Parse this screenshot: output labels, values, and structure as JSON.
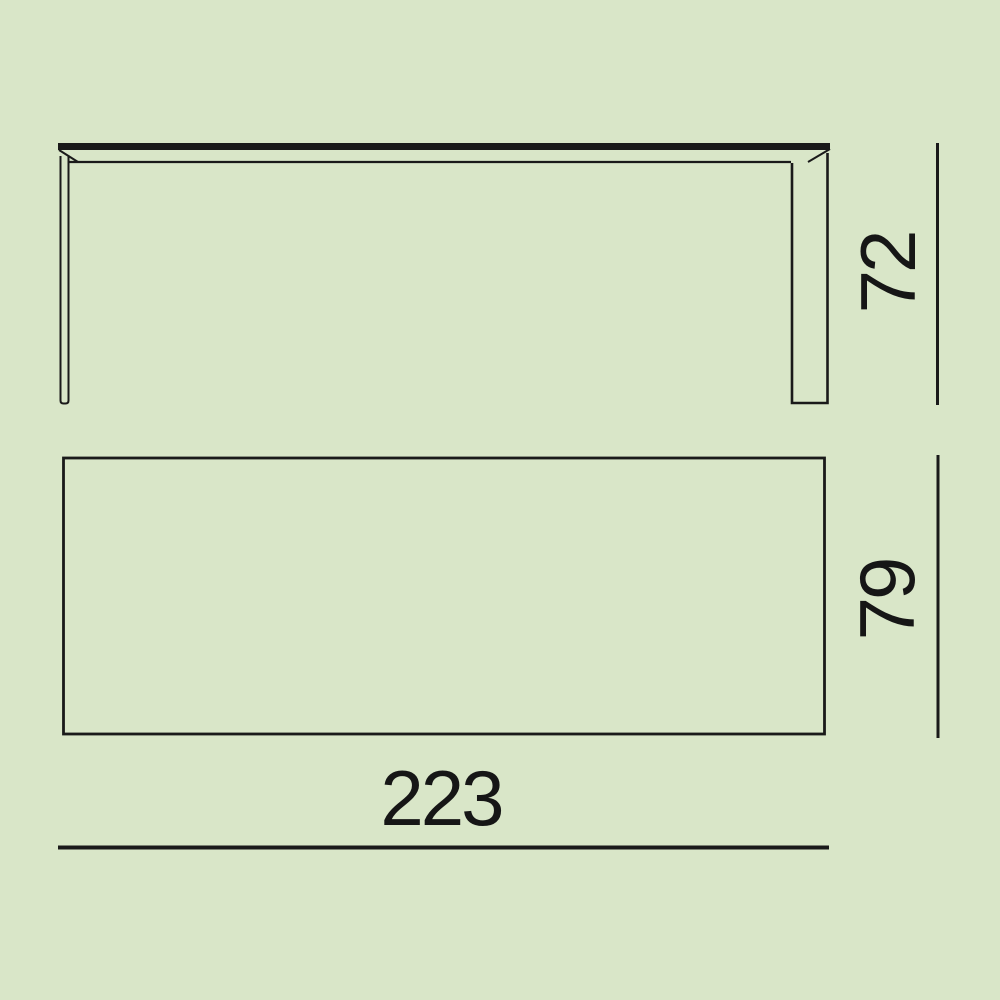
{
  "colors": {
    "background": "#d9e6c8",
    "ink": "#1a1a1a"
  },
  "dimensions": {
    "height": "72",
    "depth": "79",
    "width": "223"
  }
}
